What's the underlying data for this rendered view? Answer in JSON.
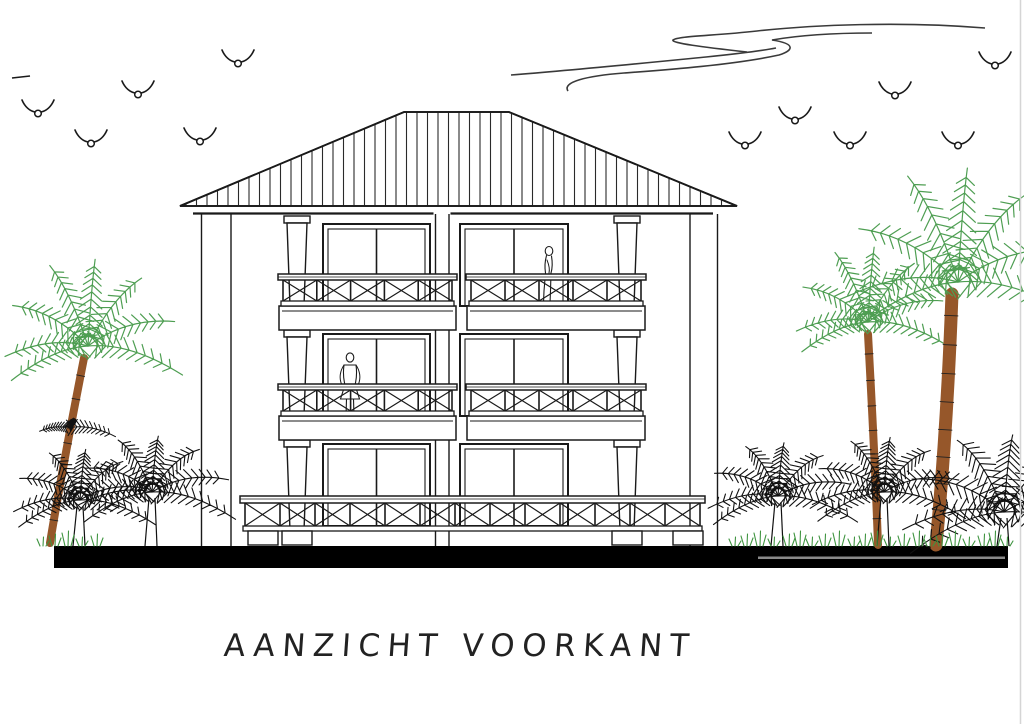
{
  "title": "AANZICHT VOORKANT",
  "sheet": {
    "width": 1024,
    "height": 724,
    "background": "#ffffff",
    "border_right_x": 1020.5
  },
  "colors": {
    "ink": "#1a1a1a",
    "roof_hatch": "#2a2a2a",
    "cloud": "#3a3a3a",
    "palm_green": "#4e9e52",
    "palm_dark": "#111111",
    "trunk_brown": "#96572a",
    "grass_green": "#3f9440",
    "ground_black": "#000000",
    "ground_stripe": "#8a8a8a",
    "border_gray": "#d5d5d5",
    "title_ink": "#222222"
  },
  "sky": {
    "clouds": [
      "M 985,28 C 900,21 812,25 757,31 C 712,36 678,36 673,40 C 671,43 702,47 747,52",
      "M 872,33 C 830,33 795,36 772,40 C 798,44 792,51 779,55 C 733,65 664,70 624,73 C 586,76 562,82 568,91",
      "M 511,75 C 575,70 655,62 706,57 C 735,54 760,51 776,48"
    ],
    "birds_left": [
      [
        238,
        60
      ],
      [
        38,
        110
      ],
      [
        138,
        91
      ],
      [
        91,
        140
      ],
      [
        200,
        138
      ]
    ],
    "birds_right": [
      [
        995,
        62
      ],
      [
        895,
        92
      ],
      [
        795,
        117
      ],
      [
        745,
        142
      ],
      [
        850,
        142
      ],
      [
        958,
        142
      ]
    ],
    "distant_dash": [
      12,
      78,
      30,
      76
    ]
  },
  "building": {
    "roof": {
      "tip_left": 180,
      "tip_right": 737,
      "ridge_left": 404,
      "ridge_right": 509,
      "ridge_y": 112,
      "eave_y": 206,
      "hatch_step": 10.5
    },
    "fascia": {
      "y": 213.5,
      "segments": [
        [
          193,
          433.5
        ],
        [
          450.5,
          713
        ]
      ]
    },
    "wall_lines": [
      201.5,
      231,
      435.5,
      449,
      690,
      717.5
    ],
    "wall_top": 214,
    "wall_bottom": 546,
    "column_x": [
      297,
      627
    ],
    "window_spans": [
      [
        323,
        430
      ],
      [
        460,
        568
      ]
    ],
    "floors": [
      {
        "window_top": 224,
        "window_bottom": 306,
        "cap_top": 216,
        "slab_bottom": 330,
        "rail": {
          "top": 274,
          "grid_top": 280,
          "grid_bottom": 301,
          "bottom": 306
        },
        "balconies": [
          [
            283,
            452
          ],
          [
            471,
            641
          ]
        ]
      },
      {
        "window_top": 334,
        "window_bottom": 416,
        "cap_top": 330,
        "slab_bottom": 440,
        "rail": {
          "top": 384,
          "grid_top": 390,
          "grid_bottom": 411,
          "bottom": 416
        },
        "balconies": [
          [
            283,
            452
          ],
          [
            471,
            641
          ]
        ]
      },
      {
        "window_top": 444,
        "window_bottom": 526,
        "cap_top": 440,
        "slab_bottom": null,
        "rail": {
          "top": 496,
          "grid_top": 503,
          "grid_bottom": 526,
          "bottom": 531
        },
        "balconies": [
          [
            245,
            700
          ]
        ]
      }
    ],
    "pedestals": [
      263,
      297,
      627,
      688
    ],
    "pedestal": {
      "y": 531,
      "w": 30,
      "h": 14
    }
  },
  "figures": [
    {
      "x": 549,
      "feet_y": 305,
      "pose": "profile"
    },
    {
      "x": 350,
      "feet_y": 419,
      "pose": "front"
    }
  ],
  "vegetation": {
    "green_palms": [
      {
        "crown": [
          88,
          346
        ],
        "size": 95,
        "trunk": [
          [
            84,
            358
          ],
          [
            62,
            470
          ],
          [
            50,
            543
          ]
        ],
        "trunk_w": 8
      },
      {
        "crown": [
          868,
          322
        ],
        "size": 82,
        "trunk": [
          [
            868,
            334
          ],
          [
            875,
            460
          ],
          [
            878,
            545
          ]
        ],
        "trunk_w": 8
      },
      {
        "crown": [
          958,
          282
        ],
        "size": 125,
        "trunk": [
          [
            952,
            294
          ],
          [
            947,
            430
          ],
          [
            936,
            545
          ]
        ],
        "trunk_w": 13
      }
    ],
    "twig": {
      "at": [
        68,
        428
      ],
      "size": 48
    },
    "dark_palms": [
      {
        "crown": [
          80,
          500
        ],
        "size": 76
      },
      {
        "crown": [
          152,
          492
        ],
        "size": 84
      },
      {
        "crown": [
          778,
          496
        ],
        "size": 80
      },
      {
        "crown": [
          884,
          492
        ],
        "size": 82
      },
      {
        "crown": [
          1004,
          512
        ],
        "size": 116
      }
    ],
    "grass_zones": [
      [
        40,
        100
      ],
      [
        732,
        1006
      ]
    ]
  },
  "ground": {
    "x": 54,
    "width": 954,
    "y": 546,
    "height": 22,
    "stripe": {
      "x": 758,
      "width": 247,
      "y": 556.5,
      "height": 2.5
    }
  }
}
